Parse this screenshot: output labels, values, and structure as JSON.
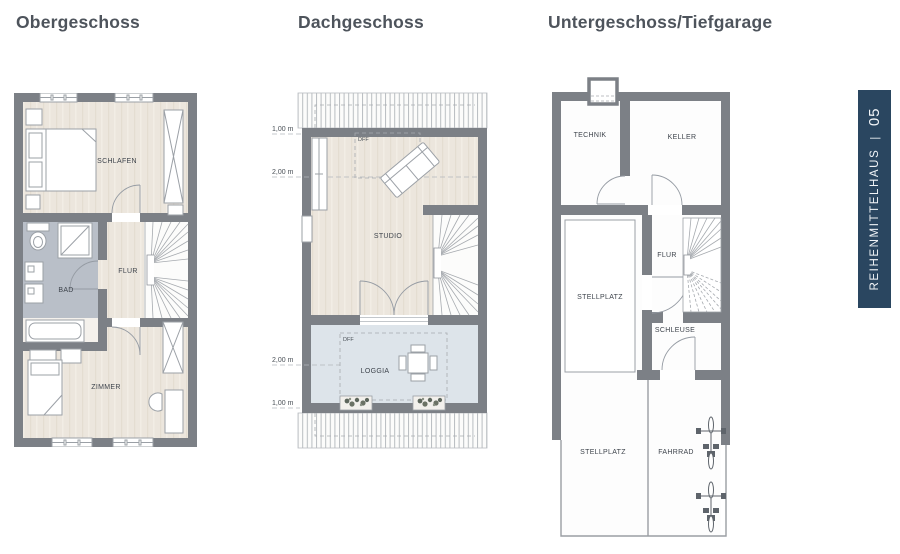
{
  "titles": {
    "plan1": "Obergeschoss",
    "plan2": "Dachgeschoss",
    "plan3": "Untergeschoss/Tiefgarage"
  },
  "plan1": {
    "rooms": {
      "schlafen": "SCHLAFEN",
      "flur": "FLUR",
      "bad": "BAD",
      "zimmer": "ZIMMER"
    }
  },
  "plan2": {
    "rooms": {
      "studio": "STUDIO",
      "loggia": "LOGGIA"
    },
    "annotations": {
      "dff_studio": "DFF",
      "dff_loggia": "DFF"
    },
    "dimensions": {
      "top_1m": "1,00 m",
      "top_2m": "2,00 m",
      "bottom_2m": "2,00 m",
      "bottom_1m": "1,00 m"
    }
  },
  "plan3": {
    "rooms": {
      "technik": "TECHNIK",
      "keller": "KELLER",
      "stellplatz_mitte": "STELLPLATZ",
      "flur": "FLUR",
      "schleuse": "SCHLEUSE",
      "stellplatz_unten": "STELLPLATZ",
      "fahrrad": "FAHRRAD"
    }
  },
  "sidebar": {
    "house_type": "REIHENMITTELHAUS",
    "separator": "|",
    "number": "05",
    "bg": "#2a4660"
  },
  "colors": {
    "wall": "#7c8086",
    "floor_wood": "#ece6dd",
    "floor_bath": "#b9bfc8",
    "floor_loggia": "#dde4ea",
    "banner_bg": "#2a4660",
    "title_text": "#4e545c"
  }
}
